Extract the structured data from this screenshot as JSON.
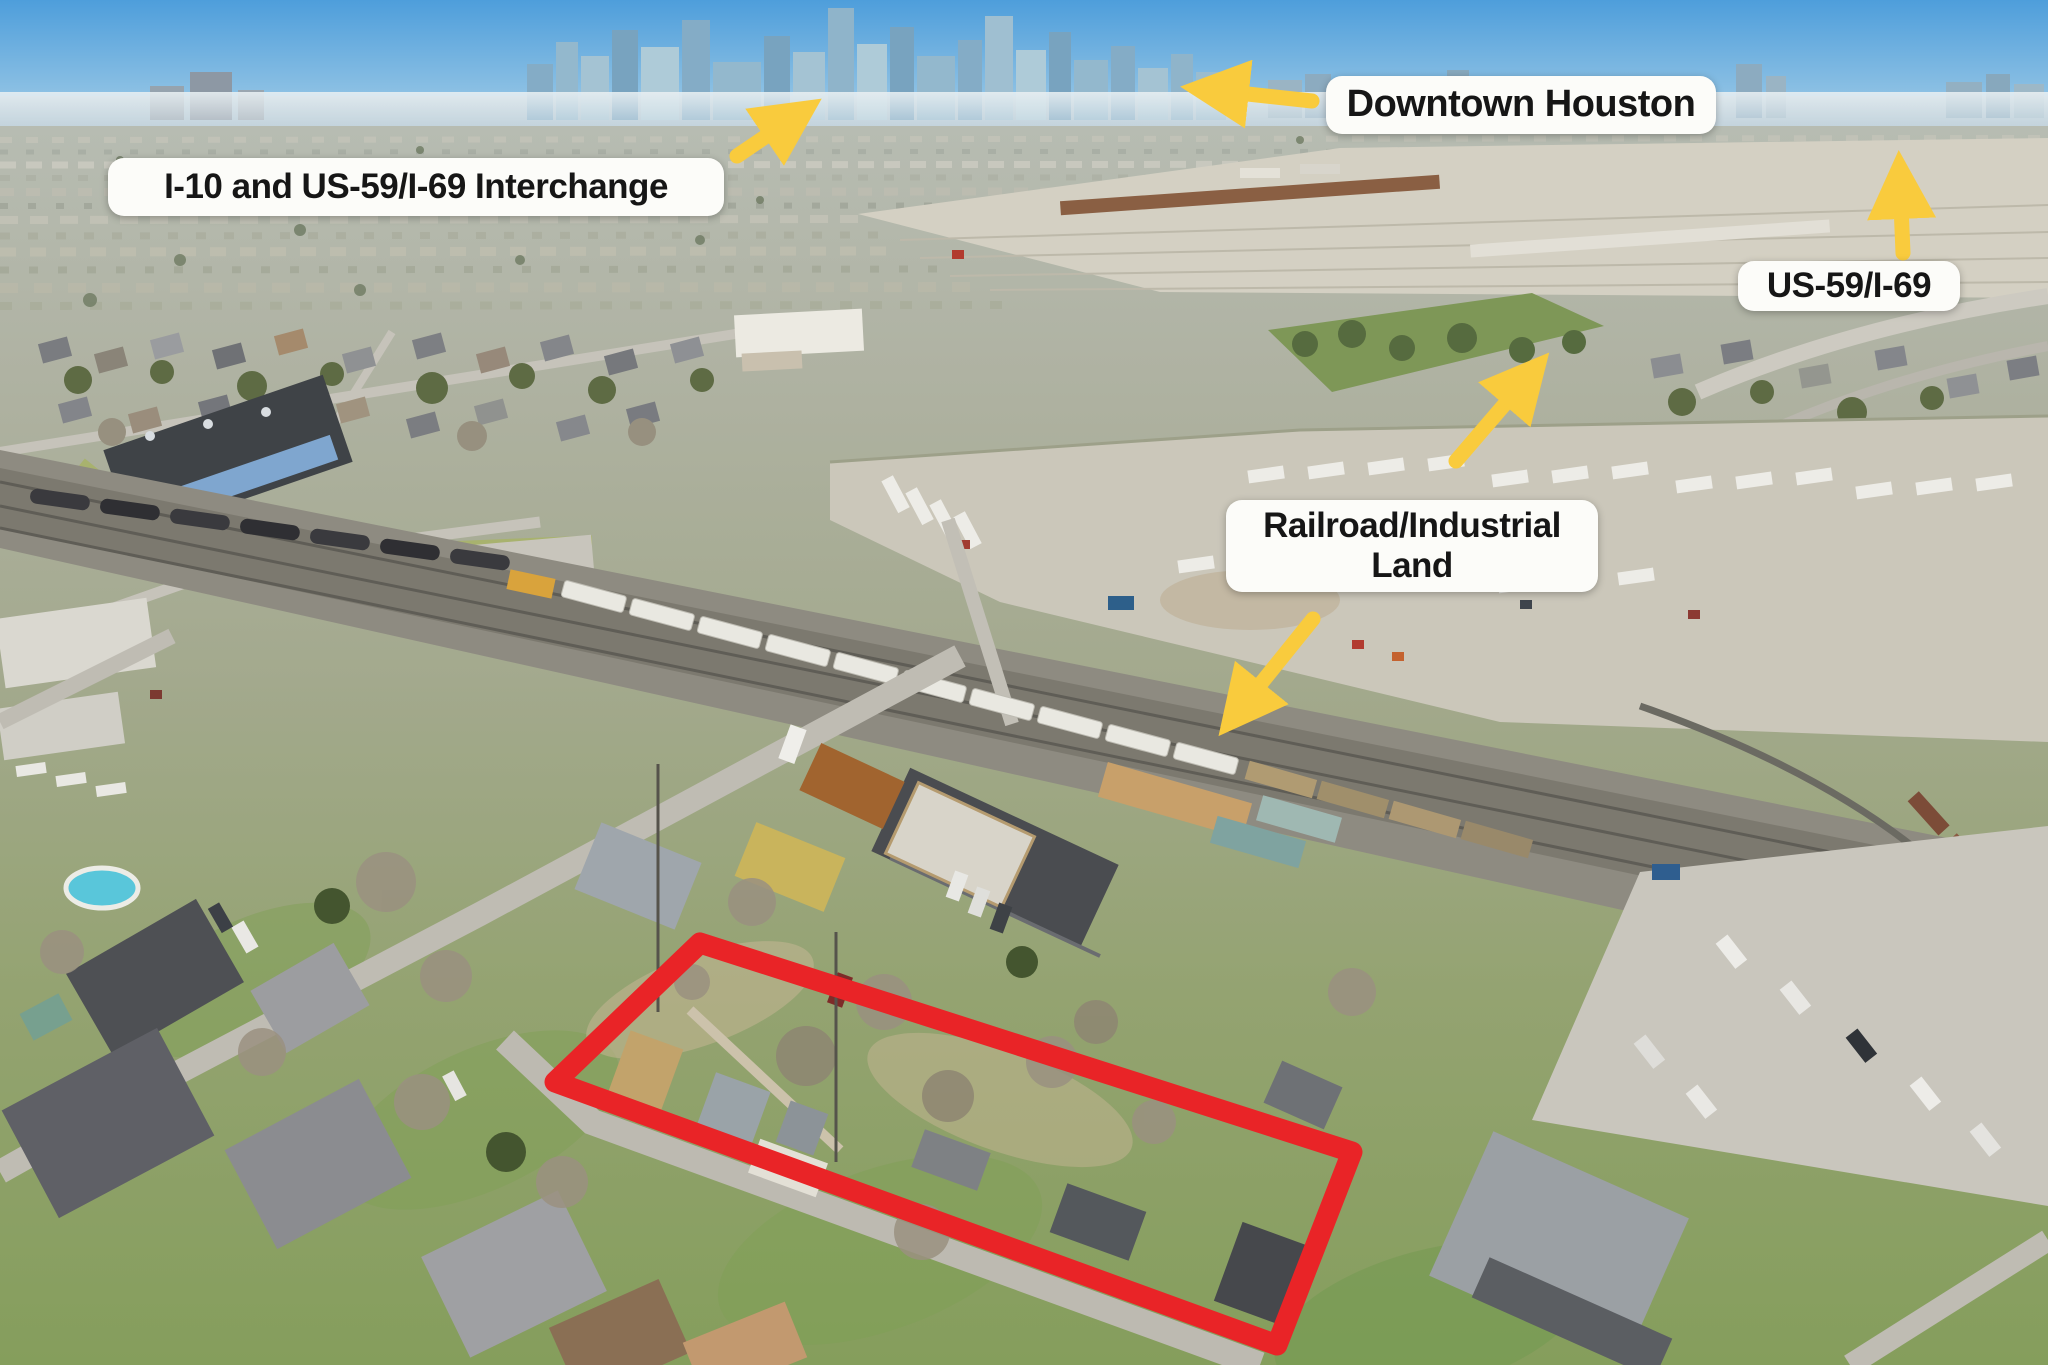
{
  "annotations": {
    "interchange": {
      "text": "I-10 and US-59/I-69 Interchange"
    },
    "downtown": {
      "text": "Downtown Houston"
    },
    "highway": {
      "text": "US-59/I-69"
    },
    "railroad_land": {
      "line1": "Railroad/Industrial",
      "line2": "Land"
    }
  },
  "arrows": [
    {
      "name": "interchange-arrow",
      "direction": "up-right"
    },
    {
      "name": "downtown-arrow",
      "direction": "left"
    },
    {
      "name": "highway-arrow",
      "direction": "up"
    },
    {
      "name": "railyard-arrow",
      "direction": "up-right"
    },
    {
      "name": "railroad-land-arrow",
      "direction": "down-left"
    }
  ],
  "property_boundary": {
    "shape": "quadrilateral",
    "color": "#E92427"
  },
  "colors": {
    "arrow_yellow": "#F9CB3D",
    "boundary_red": "#E92427",
    "label_background": "#FCFCF9",
    "label_text": "#161616",
    "sky_top": "#4E9EDB",
    "sky_horizon": "#C9DEEC"
  }
}
